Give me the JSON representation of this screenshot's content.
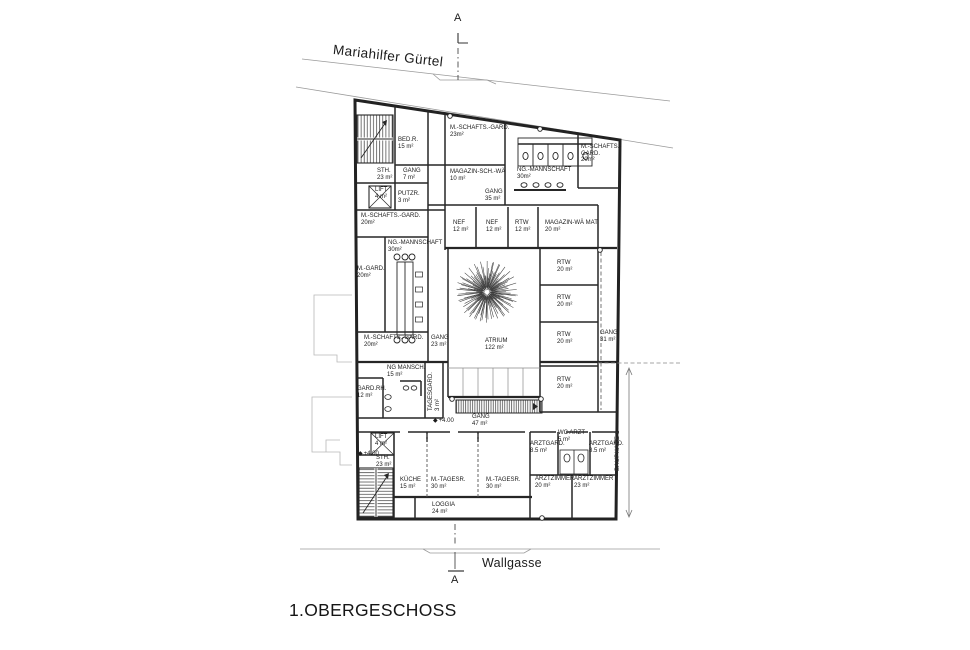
{
  "title": "1.OBERGESCHOSS",
  "streets": {
    "top": "Mariahilfer Gürtel",
    "bottom": "Wallgasse"
  },
  "markers": {
    "section": "A",
    "level": "+4.00",
    "bauphase": "BAUPHASE 1"
  },
  "colors": {
    "wall": "#262626",
    "street_line": "#9a9a9a",
    "neighbor_line": "#b8b8b8",
    "paper": "#ffffff"
  },
  "rooms": [
    {
      "lines": [
        "BED.R.",
        "15 m²"
      ],
      "x": 398,
      "y": 137
    },
    {
      "lines": [
        "M.-SCHAFTS.-GARD.",
        "23m²"
      ],
      "x": 450,
      "y": 125
    },
    {
      "lines": [
        "STH.",
        "23 m²"
      ],
      "x": 377,
      "y": 168
    },
    {
      "lines": [
        "GANG",
        "7 m²"
      ],
      "x": 403,
      "y": 168
    },
    {
      "lines": [
        "MAGAZIN-SCH.-WÄ",
        "10 m²"
      ],
      "x": 450,
      "y": 169
    },
    {
      "lines": [
        "LIFT",
        "4 m²"
      ],
      "x": 375,
      "y": 187
    },
    {
      "lines": [
        "PUTZR.",
        "3 m²"
      ],
      "x": 398,
      "y": 191
    },
    {
      "lines": [
        "GANG",
        "35 m²"
      ],
      "x": 485,
      "y": 189
    },
    {
      "lines": [
        "NG.-MANNSCHAFT",
        "30m²"
      ],
      "x": 517,
      "y": 167
    },
    {
      "lines": [
        "M.-SCHAFTS.-",
        "GARD.",
        "20m²"
      ],
      "x": 581,
      "y": 144
    },
    {
      "lines": [
        "M.-SCHAFTS.-GARD.",
        "20m²"
      ],
      "x": 361,
      "y": 213
    },
    {
      "lines": [
        "NEF",
        "12 m²"
      ],
      "x": 453,
      "y": 220
    },
    {
      "lines": [
        "NEF",
        "12 m²"
      ],
      "x": 486,
      "y": 220
    },
    {
      "lines": [
        "RTW",
        "12 m²"
      ],
      "x": 515,
      "y": 220
    },
    {
      "lines": [
        "MAGAZIN-WÄ MAT",
        "20 m²"
      ],
      "x": 545,
      "y": 220
    },
    {
      "lines": [
        "NG.-MANNSCHAFT",
        "30m²"
      ],
      "x": 388,
      "y": 240
    },
    {
      "lines": [
        "M.-GARD.",
        "20m²"
      ],
      "x": 357,
      "y": 266
    },
    {
      "lines": [
        "RTW",
        "20 m²"
      ],
      "x": 557,
      "y": 260
    },
    {
      "lines": [
        "RTW",
        "20 m²"
      ],
      "x": 557,
      "y": 295
    },
    {
      "lines": [
        "RTW",
        "20 m²"
      ],
      "x": 557,
      "y": 332
    },
    {
      "lines": [
        "GANG",
        "31 m²"
      ],
      "x": 600,
      "y": 330
    },
    {
      "lines": [
        "ATRIUM",
        "122 m²"
      ],
      "x": 485,
      "y": 338
    },
    {
      "lines": [
        "M.-SCHAFTS.-GARD.",
        "20m²"
      ],
      "x": 364,
      "y": 335
    },
    {
      "lines": [
        "GANG",
        "23 m²"
      ],
      "x": 431,
      "y": 335
    },
    {
      "lines": [
        "RTW",
        "20 m²"
      ],
      "x": 557,
      "y": 377
    },
    {
      "lines": [
        "NG MANSCH.",
        "15 m²"
      ],
      "x": 387,
      "y": 365
    },
    {
      "lines": [
        "GARD.RH.",
        "12 m²"
      ],
      "x": 357,
      "y": 386
    },
    {
      "lines": [
        "TAGESGARD.",
        "3 m²"
      ],
      "x": 428,
      "y": 411,
      "rot": -90
    },
    {
      "lines": [
        "GANG",
        "47 m²"
      ],
      "x": 472,
      "y": 414
    },
    {
      "lines": [
        "LIFT",
        "4 m²"
      ],
      "x": 375,
      "y": 434
    },
    {
      "lines": [
        "STH.",
        "23 m²"
      ],
      "x": 376,
      "y": 455
    },
    {
      "lines": [
        "KÜCHE",
        "15 m²"
      ],
      "x": 400,
      "y": 477
    },
    {
      "lines": [
        "M.-TAGESR.",
        "30 m²"
      ],
      "x": 431,
      "y": 477
    },
    {
      "lines": [
        "M.-TAGESR.",
        "30 m²"
      ],
      "x": 486,
      "y": 477
    },
    {
      "lines": [
        "LOGGIA",
        "24 m²"
      ],
      "x": 432,
      "y": 502
    },
    {
      "lines": [
        "ARZTGARD.",
        "8.5 m²"
      ],
      "x": 530,
      "y": 441
    },
    {
      "lines": [
        "WC ARZT",
        "5 m²"
      ],
      "x": 558,
      "y": 430
    },
    {
      "lines": [
        "ARZTGARD.",
        "8.5 m²"
      ],
      "x": 589,
      "y": 441
    },
    {
      "lines": [
        "ARZTZIMMER",
        "20 m²"
      ],
      "x": 535,
      "y": 476
    },
    {
      "lines": [
        "ARZTZIMMER",
        "23 m²"
      ],
      "x": 574,
      "y": 476
    }
  ],
  "level_markers": [
    {
      "x": 433,
      "y": 417
    },
    {
      "x": 358,
      "y": 450
    }
  ]
}
